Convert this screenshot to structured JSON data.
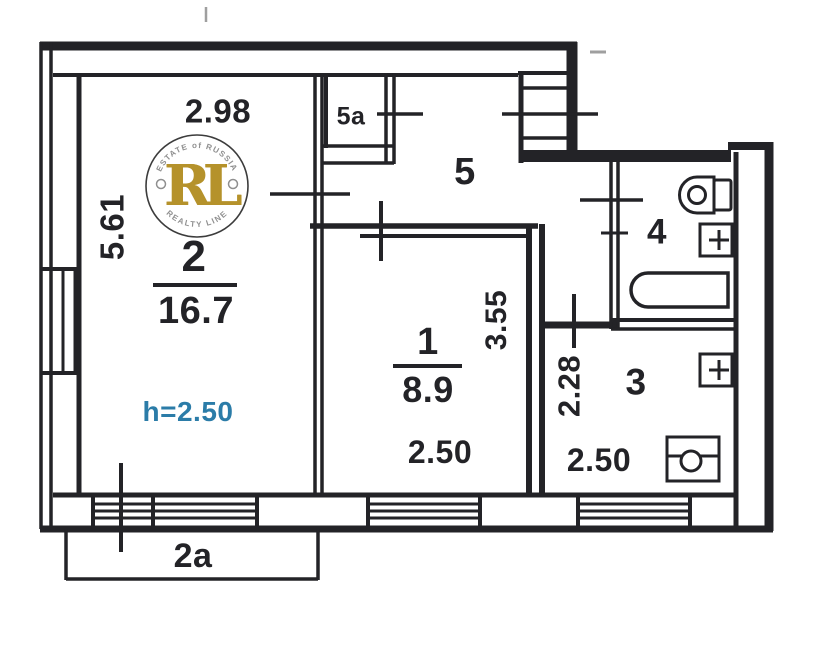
{
  "floorplan": {
    "labels": {
      "room2_number": "2",
      "room2_area": "16.7",
      "room2_width": "2.98",
      "room2_depth": "5.61",
      "room2_height_note": "h=2.50",
      "balcony_label": "2a",
      "room1_number": "1",
      "room1_area": "8.9",
      "room1_width": "2.50",
      "room1_depth": "3.55",
      "kitchen_number": "3",
      "kitchen_width": "2.50",
      "kitchen_depth": "2.28",
      "bathroom_number": "4",
      "hallway_number": "5",
      "closet_number": "5a"
    },
    "watermark": {
      "monogram": "RL",
      "arc_top": "ESTATE of RUSSIA",
      "arc_bottom": "REALTY LINE"
    },
    "colors": {
      "wall": "#232327",
      "height_note": "#2b7ca8",
      "gold": "#b5922b",
      "ring": "#3c3c3c",
      "wm_text": "#8f8f8f",
      "artifact": "#9f9f9f"
    }
  }
}
